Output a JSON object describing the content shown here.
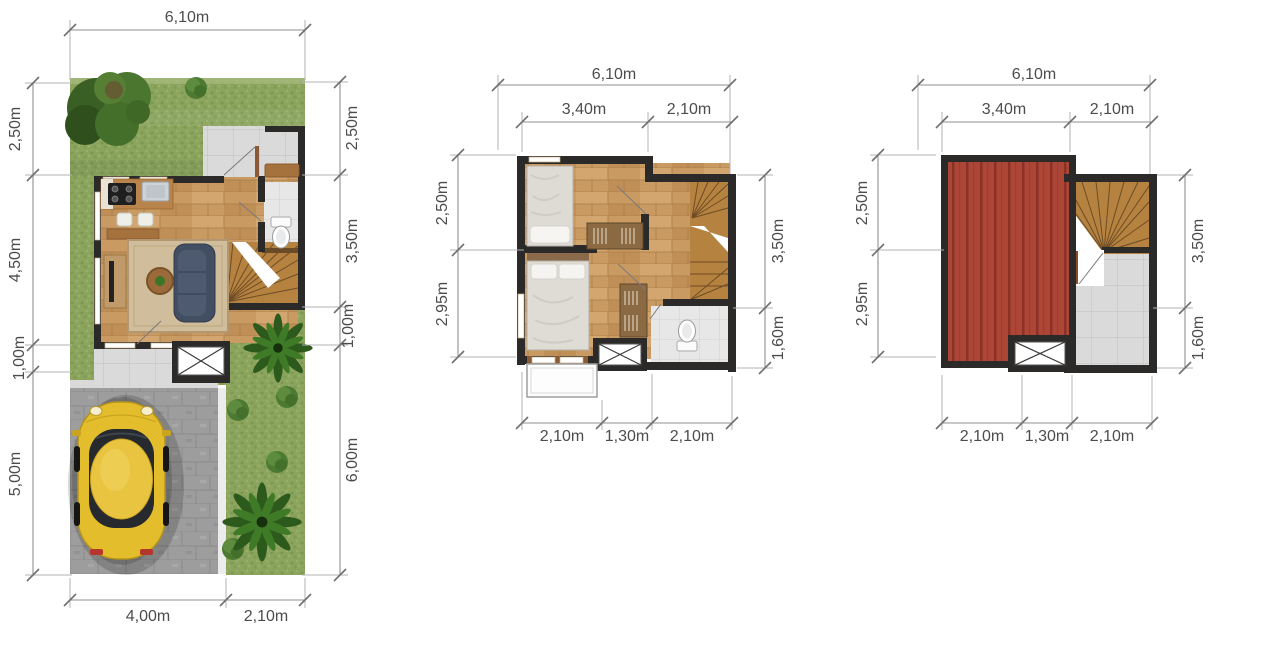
{
  "plans": {
    "site": {
      "dim_top": "6,10m",
      "dims_left": [
        "2,50m",
        "4,50m",
        "1,00m",
        "5,00m"
      ],
      "dims_right": [
        "2,50m",
        "3,50m",
        "1,00m",
        "6,00m"
      ],
      "dims_bottom": [
        "4,00m",
        "2,10m"
      ]
    },
    "floor2": {
      "dim_top": "6,10m",
      "dims_top_inner": [
        "3,40m",
        "2,10m"
      ],
      "dims_left": [
        "2,50m",
        "2,95m"
      ],
      "dims_right": [
        "3,50m",
        "1,60m"
      ],
      "dims_bottom": [
        "2,10m",
        "1,30m",
        "2,10m"
      ]
    },
    "roof": {
      "dim_top": "6,10m",
      "dims_top_inner": [
        "3,40m",
        "2,10m"
      ],
      "dims_left": [
        "2,50m",
        "2,95m"
      ],
      "dims_right": [
        "3,50m",
        "1,60m"
      ],
      "dims_bottom": [
        "2,10m",
        "1,30m",
        "2,10m"
      ]
    }
  },
  "colors": {
    "grass": "#8ba45e",
    "wood_floor": "#c99a62",
    "stair_wood": "#b5823f",
    "wall": "#2b2a28",
    "roof_red": "#ad4637",
    "tile": "#dadada",
    "paver": "#9d9d9d",
    "car_yellow": "#e3bd2c",
    "sofa_blue": "#424e61",
    "dim_text": "#4c4c4c"
  }
}
